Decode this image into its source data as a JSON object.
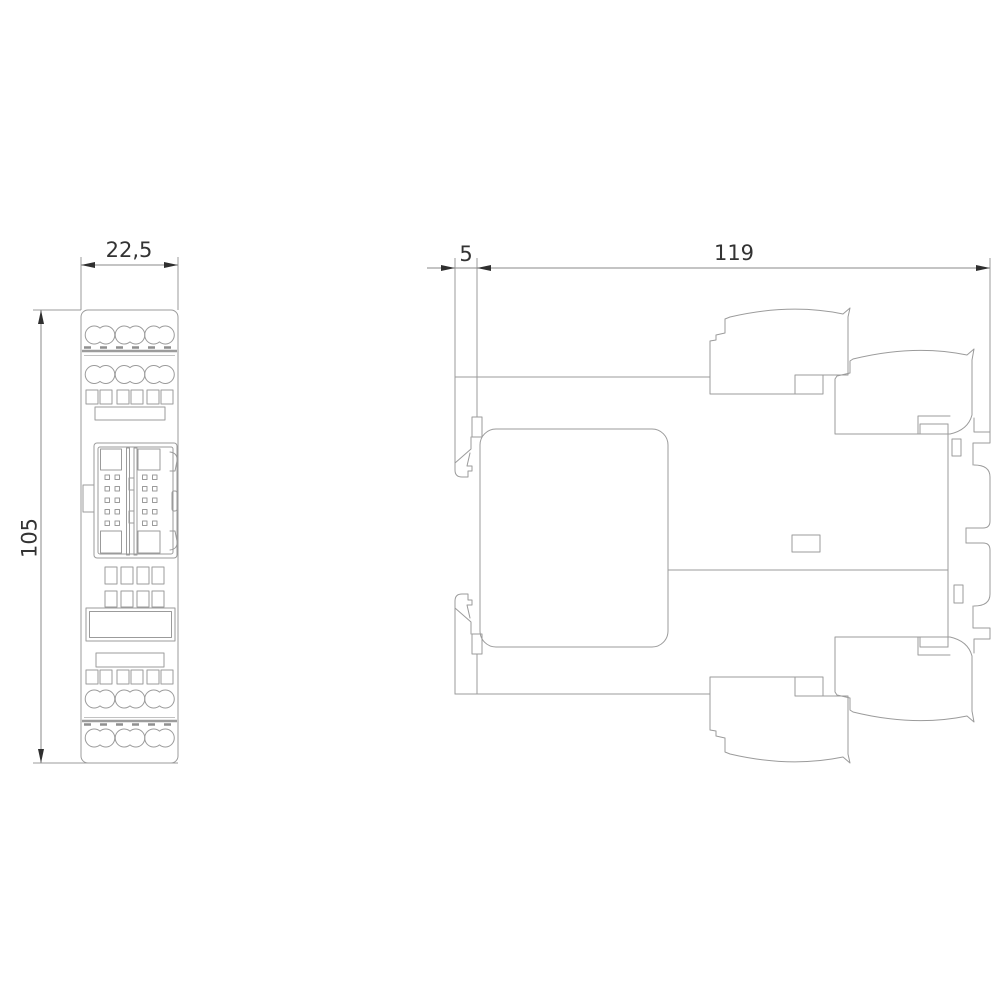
{
  "drawing": {
    "type": "technical-dimension-drawing",
    "views": {
      "front": {
        "width_label": "22,5",
        "height_label": "105"
      },
      "side": {
        "rail_offset_label": "5",
        "depth_label": "119"
      }
    },
    "colors": {
      "background": "#ffffff",
      "outline": "#9b9b9b",
      "dimension_line": "#8a8a8a",
      "arrow": "#2f2f2f",
      "text": "#333333",
      "seam": "#8f8f8f"
    }
  }
}
